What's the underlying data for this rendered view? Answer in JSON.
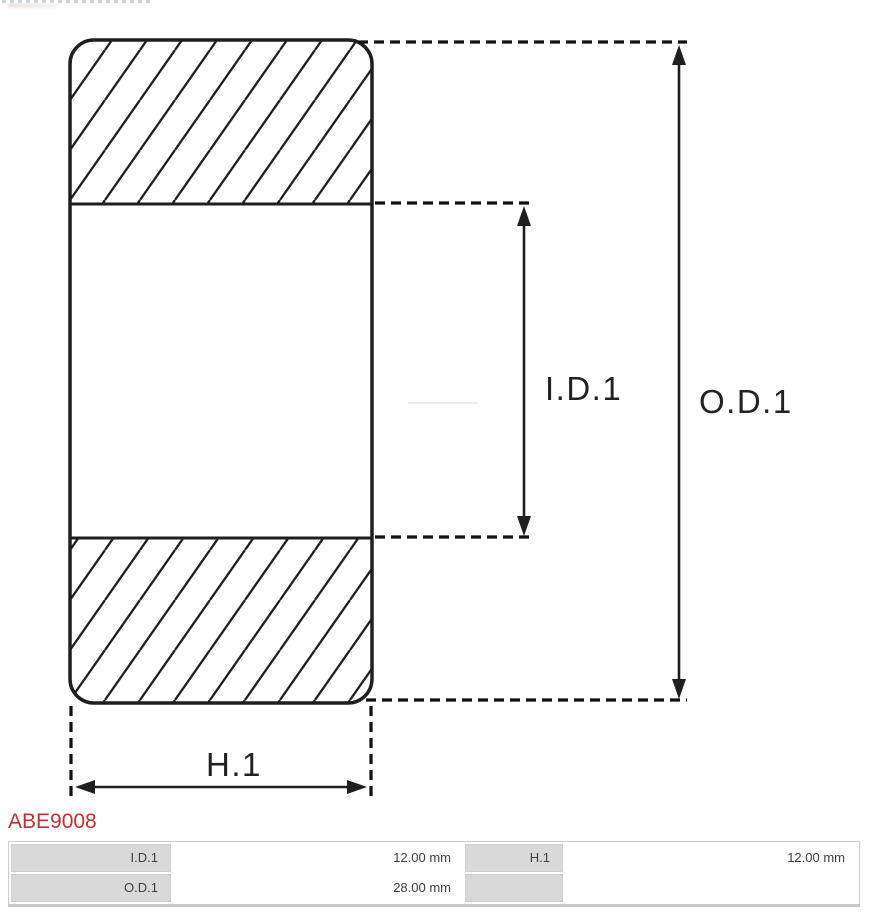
{
  "part": {
    "number": "ABE9008",
    "accent_color": "#c23131"
  },
  "diagram": {
    "description": "bearing cross-section technical drawing with hatched outer rings",
    "line_color": "#1f1f1f",
    "labels": {
      "inner_diameter": "I.D.1",
      "outer_diameter": "O.D.1",
      "height": "H.1"
    }
  },
  "spec_table": {
    "label_cell_bg": "#d9d9d9",
    "rows": [
      {
        "label1": "I.D.1",
        "value1": "12.00 mm",
        "label2": "H.1",
        "value2": "12.00 mm"
      },
      {
        "label1": "O.D.1",
        "value1": "28.00 mm",
        "label2": "",
        "value2": ""
      }
    ]
  }
}
